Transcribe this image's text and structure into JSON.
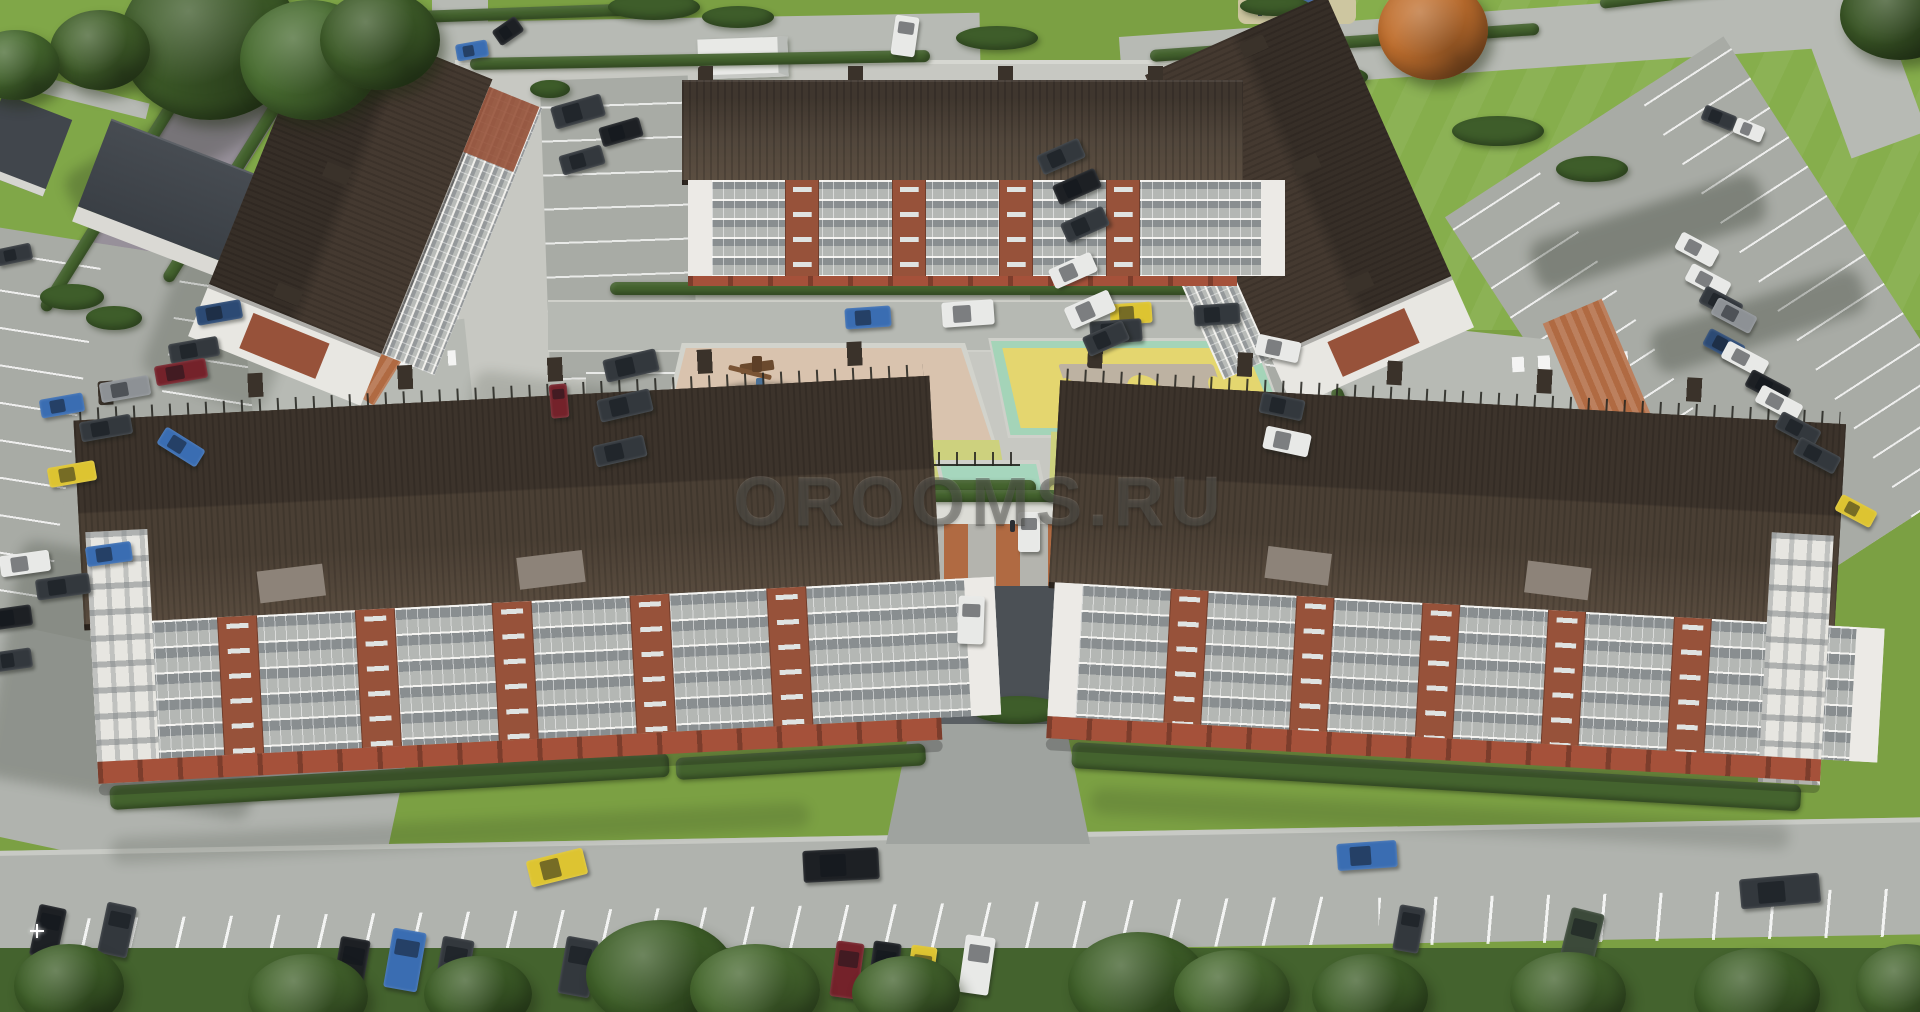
{
  "scene": {
    "watermark": "OROOMS.RU",
    "type": "aerial-3d-architectural-render",
    "description": "Bird's-eye render of a residential quarter: five 5-storey white-and-brick apartment buildings with dark brown roofs around a courtyard with a playground and a yellow sports court, surrounded by parking lots with cars, roads, lawns, hedges and trees"
  },
  "palette": {
    "grass": "#7ba043",
    "lawnLight": "#86ae4c",
    "lawnLeft": "#80a748",
    "road": "#b7bab4",
    "roadBottom": "#b0b3ae",
    "cobble": "#97909a",
    "pavement": "#c7c8c2",
    "parking": "#a8aba5",
    "darkAsphalt": "#4b5055",
    "roofDark": "#3c332b",
    "roofMid": "#4a3f34",
    "roofLight": "#584b3e",
    "facadeWhite": "#e9e8e4",
    "brick": "#97523a",
    "brickBase": "#a5513a",
    "playgroundBeige": "#d9c3ae",
    "courtMint": "#a4d4b8",
    "courtYellow": "#e4d66f",
    "courtTan": "#bdb2a2",
    "lawnStrip": "#cdd17e",
    "mintSquare": "#a6d6bd",
    "hedge": "#44632e",
    "bush": "#3e5d2a",
    "terracotta": "#b06a42",
    "watermark": "rgba(62,62,58,0.42)"
  },
  "carColors": {
    "white": "#e8e9e7",
    "black": "#1d2024",
    "darkgray": "#33383d",
    "gray": "#8d9195",
    "blue": "#3a6db2",
    "navy": "#2c4a74",
    "darkred": "#74222a",
    "yellow": "#ddc431",
    "darkgreen": "#3c4a3a"
  },
  "cars": [
    [
      196,
      303,
      46,
      19,
      -10,
      "navy"
    ],
    [
      169,
      340,
      50,
      20,
      -10,
      "darkgray"
    ],
    [
      155,
      362,
      52,
      20,
      -10,
      "darkred"
    ],
    [
      100,
      379,
      50,
      20,
      -10,
      "gray"
    ],
    [
      40,
      396,
      44,
      19,
      -10,
      "blue"
    ],
    [
      80,
      418,
      52,
      20,
      -10,
      "darkgray"
    ],
    [
      158,
      437,
      46,
      20,
      32,
      "blue"
    ],
    [
      48,
      464,
      48,
      20,
      -10,
      "yellow"
    ],
    [
      0,
      553,
      50,
      21,
      -8,
      "white"
    ],
    [
      86,
      544,
      46,
      20,
      -8,
      "blue"
    ],
    [
      36,
      576,
      54,
      21,
      -8,
      "darkgray"
    ],
    [
      -10,
      607,
      42,
      21,
      -8,
      "black"
    ],
    [
      -8,
      650,
      40,
      20,
      -8,
      "darkgray"
    ],
    [
      -4,
      246,
      36,
      17,
      -12,
      "darkgray"
    ],
    [
      552,
      100,
      52,
      23,
      -16,
      "darkgray"
    ],
    [
      600,
      122,
      42,
      20,
      -16,
      "black"
    ],
    [
      560,
      150,
      44,
      20,
      -16,
      "darkgray"
    ],
    [
      893,
      16,
      24,
      40,
      8,
      "white"
    ],
    [
      604,
      354,
      54,
      23,
      -13,
      "darkgray"
    ],
    [
      598,
      394,
      54,
      23,
      -13,
      "darkgray"
    ],
    [
      594,
      440,
      52,
      22,
      -13,
      "darkgray"
    ],
    [
      550,
      384,
      18,
      34,
      -5,
      "darkred"
    ],
    [
      845,
      307,
      46,
      21,
      -4,
      "blue"
    ],
    [
      942,
      301,
      52,
      25,
      -4,
      "white"
    ],
    [
      1110,
      303,
      42,
      21,
      -4,
      "yellow"
    ],
    [
      1090,
      320,
      52,
      23,
      -4,
      "darkgray"
    ],
    [
      1194,
      304,
      46,
      21,
      -4,
      "darkgray"
    ],
    [
      456,
      42,
      32,
      17,
      -10,
      "blue"
    ],
    [
      494,
      22,
      28,
      18,
      -35,
      "black"
    ],
    [
      1038,
      146,
      46,
      21,
      -24,
      "darkgray"
    ],
    [
      1054,
      176,
      46,
      21,
      -24,
      "black"
    ],
    [
      1062,
      214,
      46,
      21,
      -24,
      "darkgray"
    ],
    [
      1050,
      260,
      46,
      21,
      -24,
      "white"
    ],
    [
      1066,
      298,
      48,
      23,
      -24,
      "white"
    ],
    [
      1084,
      328,
      44,
      21,
      -24,
      "darkgray"
    ],
    [
      1256,
      338,
      44,
      21,
      12,
      "white"
    ],
    [
      1260,
      396,
      44,
      21,
      12,
      "darkgray"
    ],
    [
      1264,
      430,
      46,
      23,
      12,
      "white"
    ],
    [
      1676,
      240,
      42,
      19,
      28,
      "white"
    ],
    [
      1686,
      272,
      44,
      19,
      28,
      "white"
    ],
    [
      1700,
      294,
      42,
      19,
      28,
      "darkgray"
    ],
    [
      1712,
      306,
      44,
      19,
      28,
      "gray"
    ],
    [
      1704,
      336,
      40,
      19,
      28,
      "navy"
    ],
    [
      1722,
      350,
      46,
      19,
      28,
      "white"
    ],
    [
      1746,
      378,
      44,
      19,
      28,
      "black"
    ],
    [
      1756,
      394,
      46,
      19,
      28,
      "white"
    ],
    [
      1776,
      420,
      44,
      19,
      28,
      "darkgray"
    ],
    [
      1794,
      446,
      46,
      19,
      28,
      "darkgray"
    ],
    [
      1836,
      502,
      40,
      18,
      28,
      "yellow"
    ],
    [
      1702,
      110,
      34,
      16,
      22,
      "darkgray"
    ],
    [
      1734,
      122,
      30,
      16,
      22,
      "white"
    ],
    [
      528,
      854,
      58,
      27,
      -14,
      "yellow"
    ],
    [
      803,
      849,
      76,
      32,
      -3,
      "black"
    ],
    [
      1337,
      842,
      60,
      27,
      -4,
      "blue"
    ],
    [
      1740,
      876,
      80,
      30,
      -5,
      "darkgray"
    ],
    [
      336,
      938,
      30,
      58,
      10,
      "black"
    ],
    [
      388,
      930,
      34,
      60,
      10,
      "blue"
    ],
    [
      438,
      938,
      32,
      58,
      10,
      "darkgray"
    ],
    [
      562,
      938,
      32,
      58,
      10,
      "darkgray"
    ],
    [
      666,
      932,
      30,
      56,
      10,
      "white"
    ],
    [
      833,
      942,
      28,
      56,
      8,
      "darkred"
    ],
    [
      870,
      942,
      28,
      58,
      8,
      "black"
    ],
    [
      908,
      946,
      26,
      54,
      8,
      "yellow"
    ],
    [
      962,
      936,
      30,
      58,
      8,
      "white"
    ],
    [
      34,
      906,
      28,
      52,
      12,
      "black"
    ],
    [
      102,
      904,
      30,
      52,
      12,
      "darkgray"
    ],
    [
      1396,
      906,
      26,
      46,
      10,
      "darkgray"
    ],
    [
      1564,
      910,
      34,
      62,
      14,
      "darkgreen"
    ],
    [
      958,
      596,
      26,
      48,
      2,
      "white"
    ],
    [
      1018,
      512,
      22,
      40,
      0,
      "white"
    ]
  ],
  "trees": [
    [
      120,
      -40,
      180,
      160,
      "#3d5b28"
    ],
    [
      240,
      0,
      140,
      120,
      "#486c30"
    ],
    [
      50,
      10,
      100,
      80,
      "#42612b"
    ],
    [
      320,
      -10,
      120,
      100,
      "#3d5b28"
    ],
    [
      -30,
      30,
      90,
      70,
      "#486c30"
    ],
    [
      1378,
      -20,
      110,
      100,
      "#c06f2e"
    ],
    [
      1840,
      -30,
      120,
      90,
      "#3a5626"
    ],
    [
      586,
      920,
      150,
      110,
      "#3f6029"
    ],
    [
      690,
      944,
      130,
      92,
      "#47692f"
    ],
    [
      1068,
      932,
      140,
      104,
      "#3f6029"
    ],
    [
      1174,
      950,
      116,
      84,
      "#47692f"
    ],
    [
      14,
      944,
      110,
      84,
      "#3f6029"
    ],
    [
      248,
      954,
      120,
      84,
      "#44652d"
    ],
    [
      424,
      956,
      108,
      76,
      "#3f6029"
    ],
    [
      852,
      956,
      108,
      74,
      "#44652d"
    ],
    [
      1312,
      954,
      116,
      82,
      "#3f6029"
    ],
    [
      1510,
      952,
      116,
      84,
      "#44652d"
    ],
    [
      1694,
      948,
      126,
      92,
      "#3f6029"
    ],
    [
      1856,
      944,
      100,
      84,
      "#44652d"
    ]
  ],
  "bushes": [
    [
      40,
      284,
      64,
      26
    ],
    [
      86,
      306,
      56,
      24
    ],
    [
      608,
      -6,
      92,
      26
    ],
    [
      702,
      6,
      72,
      22
    ],
    [
      956,
      26,
      82,
      24
    ],
    [
      1452,
      116,
      92,
      30
    ],
    [
      1556,
      156,
      72,
      26
    ],
    [
      1306,
      66,
      62,
      22
    ],
    [
      1652,
      596,
      72,
      40
    ],
    [
      1676,
      556,
      58,
      30
    ],
    [
      116,
      734,
      92,
      30
    ],
    [
      326,
      696,
      84,
      26
    ],
    [
      376,
      658,
      72,
      24
    ],
    [
      654,
      686,
      72,
      26
    ],
    [
      972,
      696,
      92,
      28
    ],
    [
      1252,
      696,
      92,
      28
    ],
    [
      1474,
      686,
      82,
      26
    ],
    [
      1240,
      -4,
      70,
      20
    ],
    [
      530,
      80,
      40,
      18
    ],
    [
      904,
      84,
      50,
      16
    ]
  ],
  "hedges": [
    [
      388,
      12,
      300,
      12,
      -2
    ],
    [
      470,
      58,
      460,
      12,
      -1
    ],
    [
      1150,
      50,
      390,
      12,
      -4
    ],
    [
      1600,
      -2,
      330,
      11,
      -7
    ],
    [
      610,
      282,
      620,
      13,
      0
    ],
    [
      600,
      480,
      436,
      15,
      0
    ],
    [
      1058,
      476,
      246,
      15,
      2
    ],
    [
      110,
      786,
      560,
      24,
      -3.4
    ],
    [
      676,
      758,
      250,
      22,
      -3.4
    ],
    [
      1072,
      742,
      730,
      26,
      3.4
    ],
    [
      118,
      30,
      12,
      300,
      32
    ],
    [
      238,
      10,
      12,
      290,
      32
    ],
    [
      120,
      748,
      132,
      16,
      -8
    ],
    [
      900,
      490,
      168,
      12,
      0
    ],
    [
      1352,
      386,
      12,
      120,
      -22
    ]
  ],
  "shadows": [
    [
      0,
      560,
      270,
      240,
      10,
      0.22
    ],
    [
      168,
      210,
      130,
      190,
      21,
      0.18
    ],
    [
      1528,
      206,
      240,
      52,
      -18,
      0.3
    ],
    [
      1648,
      298,
      220,
      46,
      -18,
      0.28
    ],
    [
      60,
      120,
      220,
      60,
      -30,
      0.25
    ],
    [
      470,
      380,
      160,
      60,
      8,
      0.15
    ],
    [
      690,
      282,
      560,
      16,
      0,
      0.18
    ],
    [
      110,
      820,
      700,
      26,
      -3,
      0.15
    ],
    [
      1090,
      806,
      700,
      26,
      3,
      0.15
    ]
  ],
  "sparks": [
    [
      344,
      982
    ],
    [
      30,
      924
    ]
  ]
}
